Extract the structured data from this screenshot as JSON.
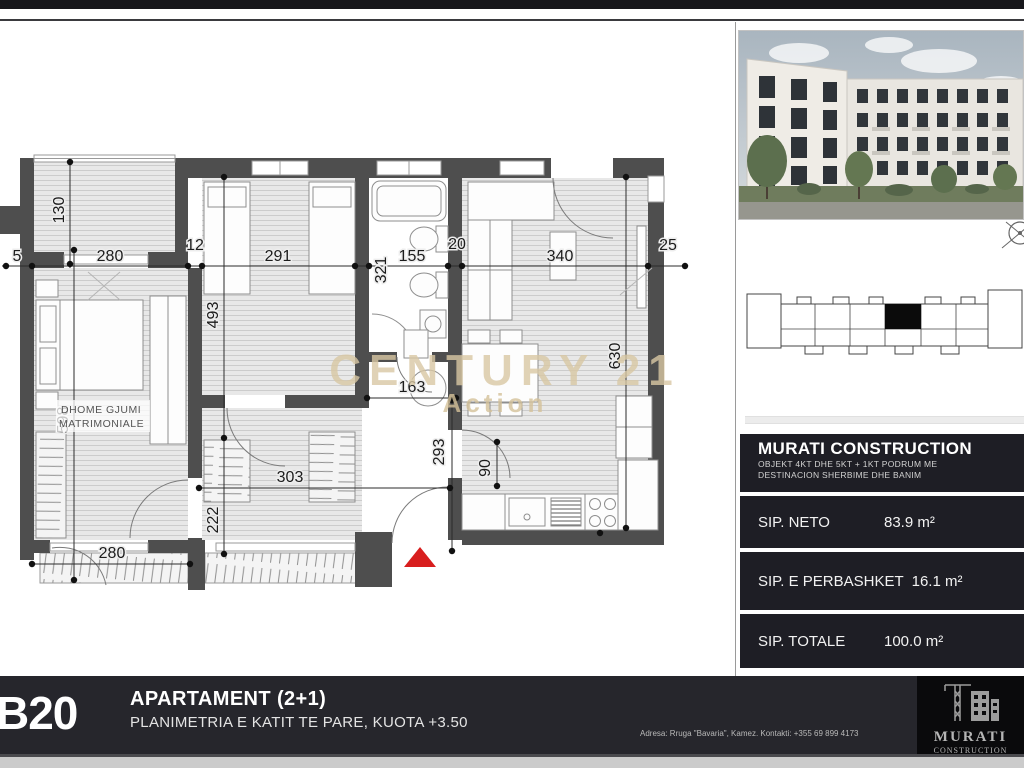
{
  "plan": {
    "dims": {
      "d5": "5",
      "d280_top": "280",
      "d12": "12",
      "d291": "291",
      "d321": "321",
      "d155": "155",
      "d20": "20",
      "d340": "340",
      "d25": "25",
      "d130": "130",
      "d493": "493",
      "d598": "598",
      "d630": "630",
      "d163": "163",
      "d293": "293",
      "d90": "90",
      "d303": "303",
      "d222": "222",
      "d280_bottom": "280"
    },
    "room_label_line1": "DHOME GJUMI",
    "room_label_line2": "MATRIMONIALE",
    "watermark_line1": "CENTURY 21",
    "watermark_line2": "Action",
    "entry_marker_color": "#d81e1e"
  },
  "sidebar": {
    "company": {
      "title": "MURATI CONSTRUCTION",
      "desc_line1": "OBJEKT 4KT DHE 5KT + 1KT PODRUM ME",
      "desc_line2": "DESTINACION  SHERBIME DHE BANIM"
    },
    "stats": [
      {
        "label": "SIP. NETO",
        "value": "83.9 m²"
      },
      {
        "label": "SIP. E PERBASHKET",
        "value": "16.1 m²"
      },
      {
        "label": "SIP. TOTALE",
        "value": "100.0 m²"
      }
    ],
    "panel_bg": "#1e1e25"
  },
  "footer": {
    "unit_code": "B20",
    "title": "APARTAMENT (2+1)",
    "subtitle": "PLANIMETRIA E KATIT TE PARE, KUOTA +3.50",
    "address": "Adresa: Rruga \"Bavaria\", Kamez. Kontakti: +355 69 899 4173",
    "logo_line1": "MURATI",
    "logo_line2": "CONSTRUCTION"
  }
}
